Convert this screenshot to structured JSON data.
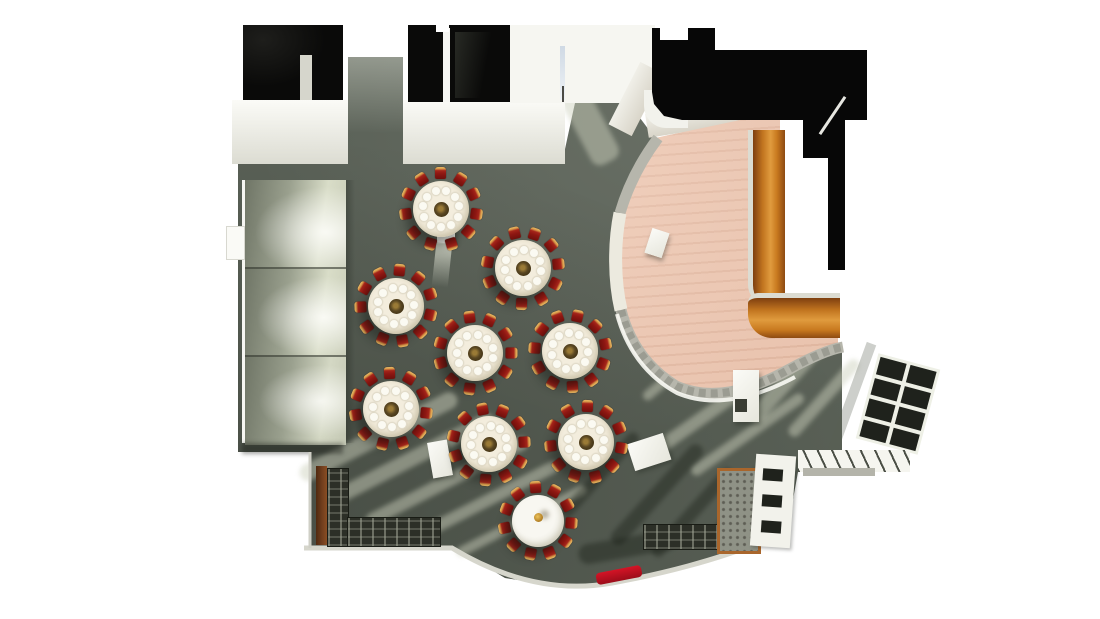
{
  "meta": {
    "type": "3d-floorplan-render",
    "subject": "Top-down 3D rendering of a banquet hall with round dining tables, lobby and bar"
  },
  "canvas": {
    "width": 1100,
    "height": 619
  },
  "colors": {
    "background": "#ffffff",
    "carpet": "#596056",
    "carpet_stripe_light": "#cdd2bd",
    "wall_white": "#f4f4ee",
    "wall_shade": "#d8d4c8",
    "void_black": "#070707",
    "wood_floor": "#e9c3ae",
    "bench_wood": "#c1741f",
    "bench_trim": "#dcdcd2",
    "stone_wall": "#b6b6ac",
    "panel_wall": "#a8ae9a",
    "tablecloth": "#efe8d6",
    "plate": "#fbfaf2",
    "centerpiece_dark": "#4c3c1c",
    "chair_red": "#8e1712",
    "chair_gold": "#d99c4a",
    "plain_table": "#f4f3ec",
    "buffet_dark": "#2c2f27",
    "glass_dark": "#1f221c",
    "screen_frame": "#a9662c",
    "red_mat": "#bf1220",
    "sky_reflection": "#cfd9e4"
  },
  "tables": {
    "set_table_count": 8,
    "plain_table_count": 1,
    "chairs_per_table": 11,
    "plates_per_table": 11,
    "items": [
      {
        "id": "table-1",
        "type": "set",
        "cx": 441,
        "cy": 209,
        "r": 28,
        "chairs": 11,
        "chair_ring": 36,
        "plates": 11,
        "plate_ring": 18.5,
        "rot": 8
      },
      {
        "id": "table-2",
        "type": "set",
        "cx": 523,
        "cy": 268,
        "r": 28,
        "chairs": 11,
        "chair_ring": 36,
        "plates": 11,
        "plate_ring": 18.5,
        "rot": -6
      },
      {
        "id": "table-3",
        "type": "set",
        "cx": 396,
        "cy": 306,
        "r": 28,
        "chairs": 11,
        "chair_ring": 36,
        "plates": 11,
        "plate_ring": 18.5,
        "rot": 14
      },
      {
        "id": "table-4",
        "type": "set",
        "cx": 475,
        "cy": 353,
        "r": 28,
        "chairs": 11,
        "chair_ring": 36,
        "plates": 11,
        "plate_ring": 18.5,
        "rot": 0
      },
      {
        "id": "table-5",
        "type": "set",
        "cx": 570,
        "cy": 351,
        "r": 28,
        "chairs": 11,
        "chair_ring": 36,
        "plates": 11,
        "plate_ring": 18.5,
        "rot": -12
      },
      {
        "id": "table-6",
        "type": "set",
        "cx": 391,
        "cy": 409,
        "r": 28,
        "chairs": 11,
        "chair_ring": 36,
        "plates": 11,
        "plate_ring": 18.5,
        "rot": 6
      },
      {
        "id": "table-7",
        "type": "set",
        "cx": 489,
        "cy": 444,
        "r": 28,
        "chairs": 11,
        "chair_ring": 36,
        "plates": 11,
        "plate_ring": 18.5,
        "rot": -3
      },
      {
        "id": "table-8",
        "type": "set",
        "cx": 586,
        "cy": 442,
        "r": 28,
        "chairs": 11,
        "chair_ring": 36,
        "plates": 11,
        "plate_ring": 18.5,
        "rot": 10
      },
      {
        "id": "table-9",
        "type": "plain",
        "cx": 538,
        "cy": 521,
        "r": 26,
        "chairs": 11,
        "chair_ring": 34,
        "plates": 0,
        "plate_ring": 0,
        "rot": 4
      }
    ]
  },
  "light_stripes": [
    {
      "x": 378,
      "y": 436,
      "len": 175,
      "w": 17,
      "rot": -27,
      "tone": "light"
    },
    {
      "x": 410,
      "y": 459,
      "len": 185,
      "w": 15,
      "rot": -27,
      "tone": "light"
    },
    {
      "x": 447,
      "y": 481,
      "len": 180,
      "w": 13,
      "rot": -27,
      "tone": "light"
    },
    {
      "x": 484,
      "y": 502,
      "len": 165,
      "w": 12,
      "rot": -27,
      "tone": "light"
    },
    {
      "x": 521,
      "y": 521,
      "len": 145,
      "w": 10,
      "rot": -27,
      "tone": "light"
    },
    {
      "x": 588,
      "y": 122,
      "len": 90,
      "w": 30,
      "rot": 62,
      "tone": "light"
    },
    {
      "x": 704,
      "y": 416,
      "len": 150,
      "w": 13,
      "rot": -35,
      "tone": "light"
    },
    {
      "x": 747,
      "y": 434,
      "len": 135,
      "w": 11,
      "rot": -35,
      "tone": "light"
    },
    {
      "x": 790,
      "y": 377,
      "len": 115,
      "w": 16,
      "rot": -48,
      "tone": "light"
    },
    {
      "x": 824,
      "y": 398,
      "len": 100,
      "w": 12,
      "rot": -48,
      "tone": "light"
    },
    {
      "x": 690,
      "y": 360,
      "len": 120,
      "w": 10,
      "rot": -40,
      "tone": "light"
    },
    {
      "x": 657,
      "y": 494,
      "len": 130,
      "w": 15,
      "rot": -48,
      "tone": "dark"
    },
    {
      "x": 692,
      "y": 512,
      "len": 115,
      "w": 13,
      "rot": -48,
      "tone": "dark"
    },
    {
      "x": 628,
      "y": 547,
      "len": 100,
      "w": 20,
      "rot": -10,
      "tone": "dark"
    },
    {
      "x": 736,
      "y": 505,
      "len": 95,
      "w": 11,
      "rot": -55,
      "tone": "dark"
    },
    {
      "x": 600,
      "y": 475,
      "len": 110,
      "w": 12,
      "rot": -48,
      "tone": "dark"
    }
  ]
}
